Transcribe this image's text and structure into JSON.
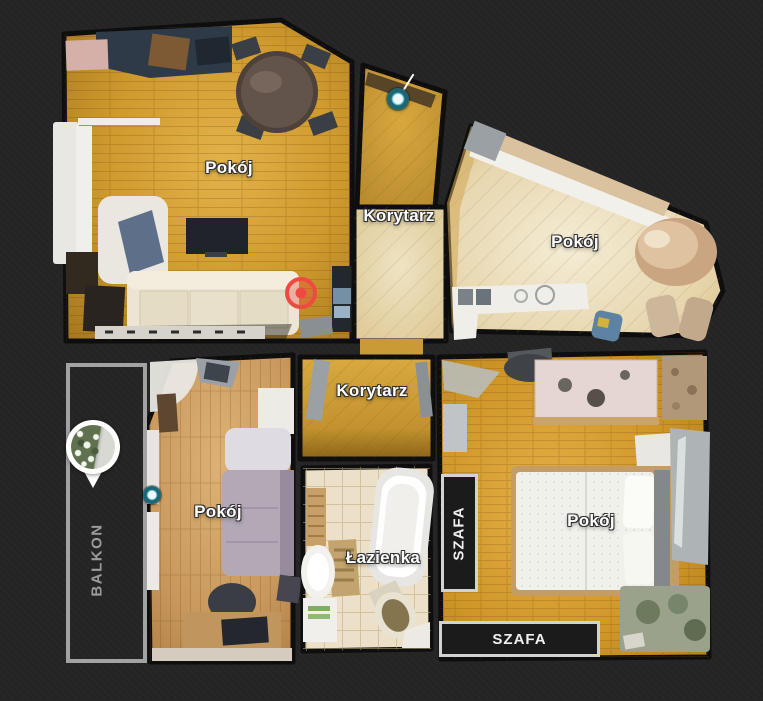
{
  "scene": {
    "title": "Apartment floor plan – top view",
    "background": "#242424"
  },
  "rooms": [
    {
      "id": "living-room",
      "label": "Pokój"
    },
    {
      "id": "corridor-upper",
      "label": "Korytarz"
    },
    {
      "id": "kitchen-room",
      "label": "Pokój"
    },
    {
      "id": "corridor-lower",
      "label": "Korytarz"
    },
    {
      "id": "small-room",
      "label": "Pokój"
    },
    {
      "id": "bathroom",
      "label": "Łazienka"
    },
    {
      "id": "bedroom",
      "label": "Pokój"
    }
  ],
  "annotations": {
    "balcony_label": "BALKON",
    "wardrobe_label_side": "SZAFA",
    "wardrobe_label_bottom": "SZAFA"
  },
  "markers": {
    "sweep_color": "#1c6775",
    "tag_color": "#ee4a41",
    "pin_fill": "#ffffff"
  },
  "colors": {
    "background": "#242424",
    "wall": "#0e0e0e",
    "balcony_border": "#a2a2a2",
    "wardrobe_box_border": "#d2d2d2",
    "wardrobe_box_fill": "#1b1b1b",
    "label_text": "#ffffff",
    "balcony_text": "#9b9c9c"
  }
}
